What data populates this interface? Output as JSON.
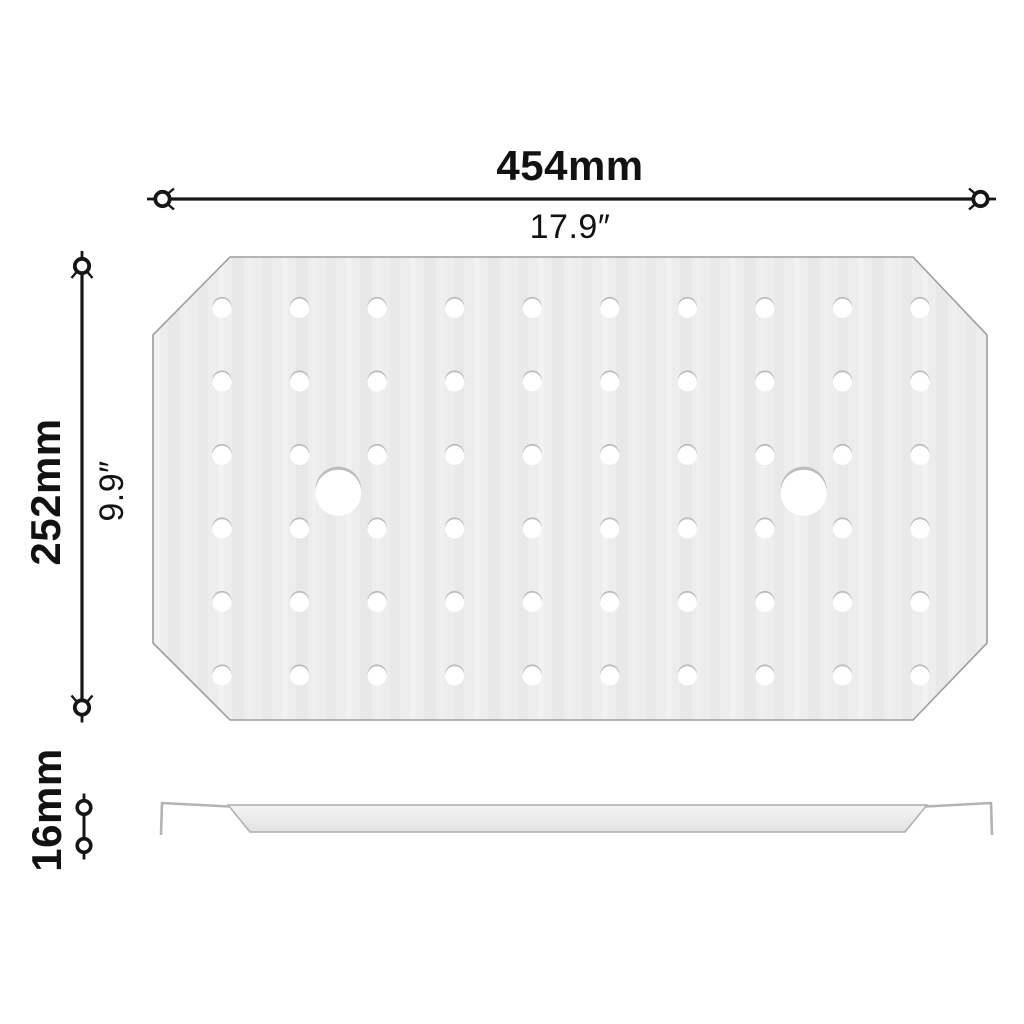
{
  "diagram": {
    "description": "Dimension drawing of an octagonal perforated false-bottom drain plate, top view and side profile",
    "labels": {
      "width_metric": "454mm",
      "width_imperial": "17.9″",
      "depth_metric": "252mm",
      "depth_imperial": "9.9″",
      "thickness_metric": "16mm"
    },
    "views": {
      "top_view": {
        "shape": "octagonal-perforated-plate",
        "small_holes": {
          "rows": 6,
          "cols": 10,
          "count": 60
        },
        "large_holes": {
          "count": 2
        }
      },
      "side_view": {
        "shape": "thin-tray-profile-with-hooked-ends"
      }
    },
    "colors": {
      "line": "#161616",
      "text": "#121212",
      "plate_fill": "#ededed",
      "plate_stroke": "#9d9d9d",
      "hole_fill": "#ffffff",
      "hole_shadow": "#bdbdbd",
      "profile_stroke": "#ababab"
    }
  }
}
